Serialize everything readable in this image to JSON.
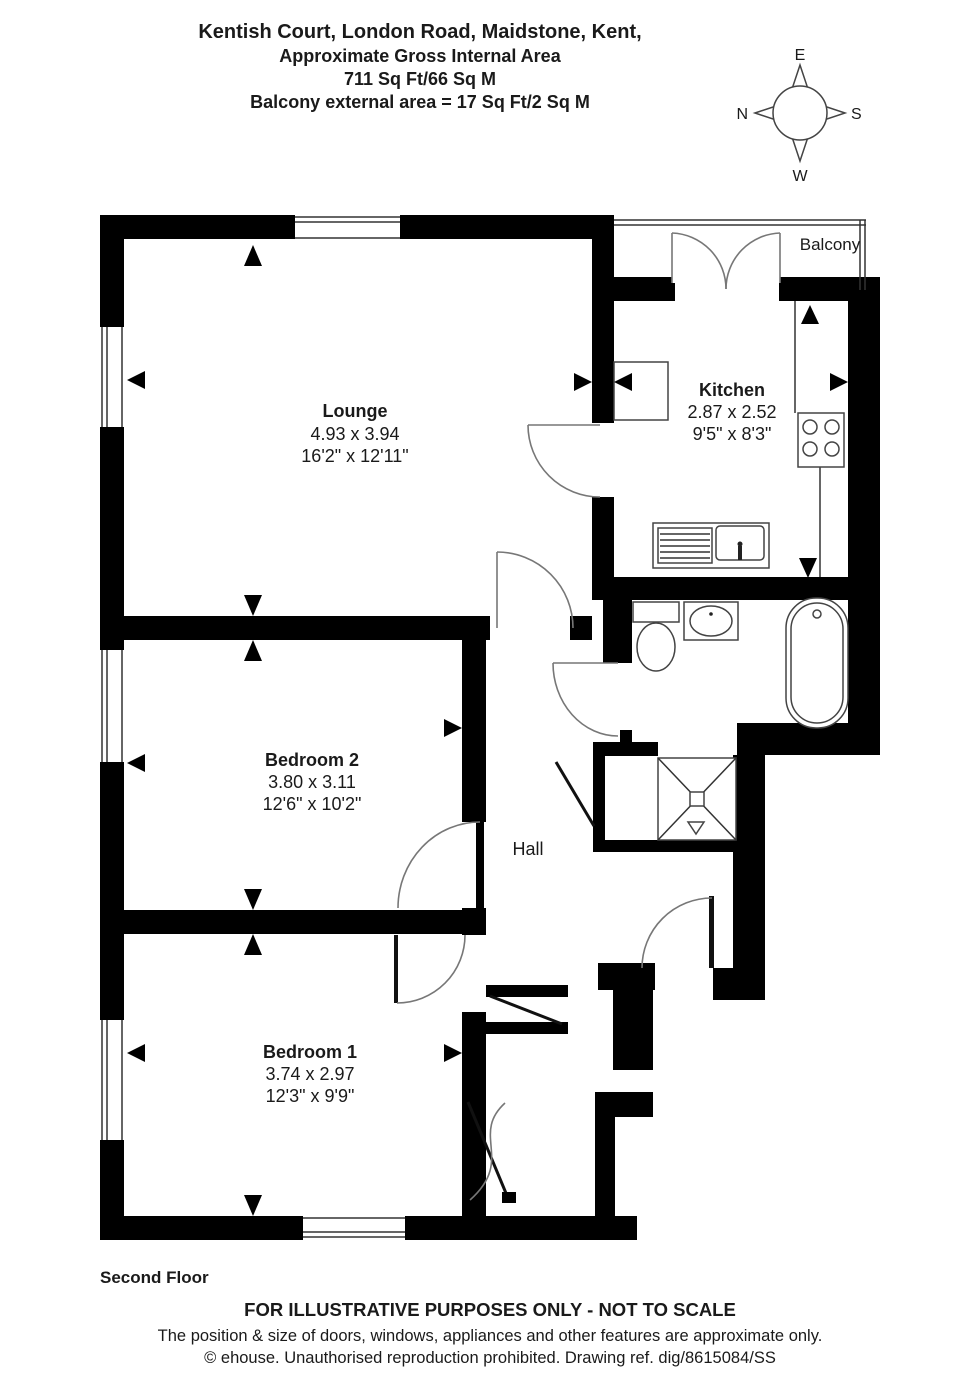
{
  "title": {
    "line1": "Kentish Court, London Road, Maidstone, Kent,",
    "line2": "Approximate Gross Internal Area",
    "line3": "711 Sq Ft/66 Sq M",
    "line4": "Balcony external area = 17 Sq Ft/2 Sq M"
  },
  "compass": {
    "top": "E",
    "left": "N",
    "right": "S",
    "bottom": "W"
  },
  "rooms": {
    "lounge": {
      "name": "Lounge",
      "metric": "4.93 x 3.94",
      "imperial": "16'2\" x 12'11\""
    },
    "kitchen": {
      "name": "Kitchen",
      "metric": "2.87 x 2.52",
      "imperial": "9'5\" x 8'3\""
    },
    "bedroom2": {
      "name": "Bedroom 2",
      "metric": "3.80 x 3.11",
      "imperial": "12'6\" x 10'2\""
    },
    "bedroom1": {
      "name": "Bedroom 1",
      "metric": "3.74 x 2.97",
      "imperial": "12'3\" x 9'9\""
    },
    "hall": {
      "name": "Hall"
    },
    "balcony": {
      "name": "Balcony"
    }
  },
  "footer": {
    "floor": "Second Floor",
    "disclaimer": "FOR ILLUSTRATIVE PURPOSES ONLY - NOT TO SCALE",
    "note": "The position & size of doors, windows, appliances and other features are approximate only.",
    "copyright": "© ehouse. Unauthorised reproduction prohibited. Drawing ref. dig/8615084/SS"
  },
  "colors": {
    "wall": "#000000",
    "line": "#555555",
    "background": "#ffffff"
  }
}
